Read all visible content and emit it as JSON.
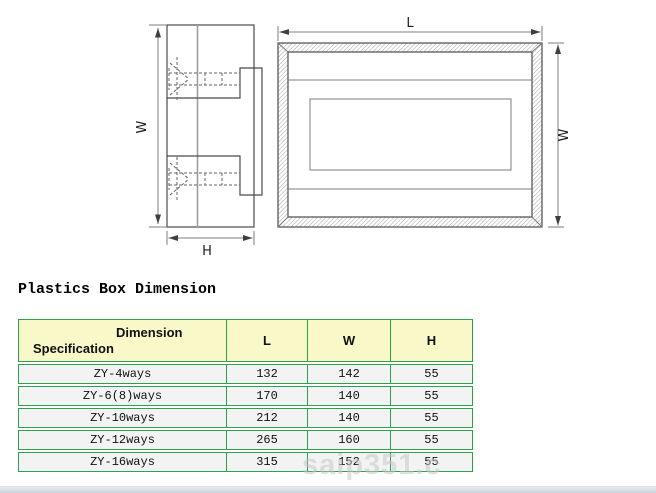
{
  "title": "Plastics Box Dimension",
  "watermark": "saip351.c",
  "colors": {
    "table_border_green": "#2ca24c",
    "header_bg_yellow": "#f8f8c8",
    "row_bg_gray": "#f2f3f2",
    "drawing_line": "#4b4b4b",
    "dimension_line_gray": "#7c7c7c",
    "bottom_bar": "#c9d2de"
  },
  "diagrams": {
    "side_view": {
      "width_label": "W",
      "height_label": "H"
    },
    "top_view": {
      "length_label": "L",
      "width_label": "W"
    }
  },
  "table": {
    "header": {
      "dimension_label": "Dimension",
      "specification_label": "Specification",
      "columns": [
        "L",
        "W",
        "H"
      ]
    },
    "rows": [
      {
        "spec": "ZY-4ways",
        "l": "132",
        "w": "142",
        "h": "55"
      },
      {
        "spec": "ZY-6(8)ways",
        "l": "170",
        "w": "140",
        "h": "55"
      },
      {
        "spec": "ZY-10ways",
        "l": "212",
        "w": "140",
        "h": "55"
      },
      {
        "spec": "ZY-12ways",
        "l": "265",
        "w": "160",
        "h": "55"
      },
      {
        "spec": "ZY-16ways",
        "l": "315",
        "w": "152",
        "h": "55"
      }
    ]
  }
}
